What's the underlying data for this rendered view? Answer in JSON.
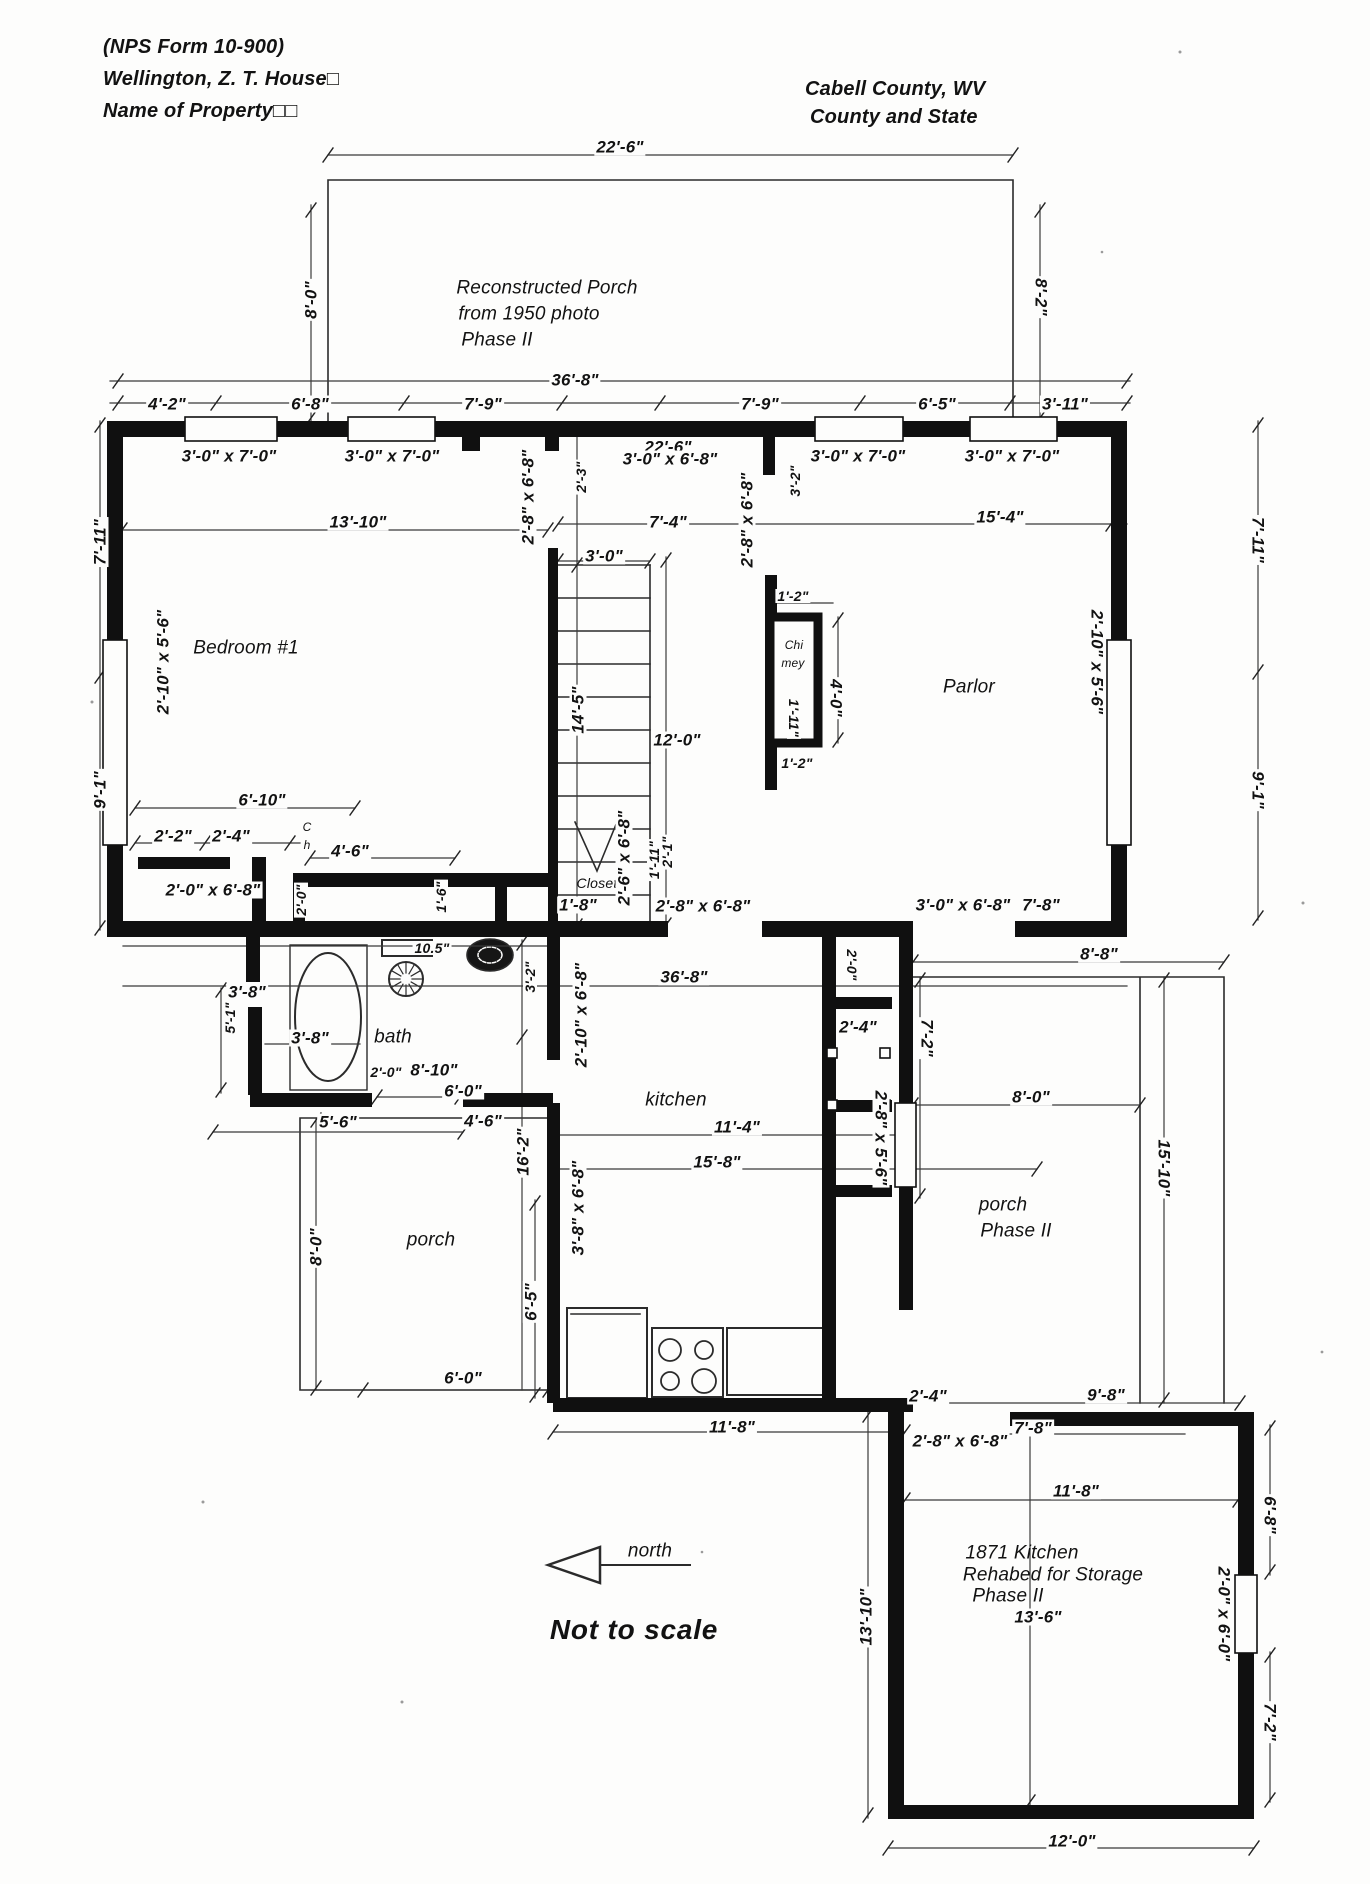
{
  "header": {
    "left": [
      "(NPS Form 10-900)",
      "Wellington, Z. T. House□",
      "Name of Property□□"
    ],
    "right": [
      "Cabell County, WV",
      "County and State"
    ]
  },
  "labels": [
    {
      "t": "22'-6\"",
      "x": 620,
      "y": 147
    },
    {
      "t": "8'-0\"",
      "x": 311,
      "y": 300,
      "c": "rm90"
    },
    {
      "t": "8'-2\"",
      "x": 1041,
      "y": 297,
      "c": "r90"
    },
    {
      "t": "Reconstructed Porch",
      "x": 547,
      "y": 288,
      "c": "room"
    },
    {
      "t": "from 1950 photo",
      "x": 529,
      "y": 314,
      "c": "room"
    },
    {
      "t": "Phase II",
      "x": 497,
      "y": 340,
      "c": "room"
    },
    {
      "t": "36'-8\"",
      "x": 575,
      "y": 380
    },
    {
      "t": "4'-2\"",
      "x": 167,
      "y": 404
    },
    {
      "t": "6'-8\"",
      "x": 310,
      "y": 404
    },
    {
      "t": "7'-9\"",
      "x": 483,
      "y": 404
    },
    {
      "t": "7'-9\"",
      "x": 760,
      "y": 404
    },
    {
      "t": "6'-5\"",
      "x": 937,
      "y": 404
    },
    {
      "t": "3'-11\"",
      "x": 1065,
      "y": 404
    },
    {
      "t": "3'-0\" x 7'-0\"",
      "x": 229,
      "y": 456
    },
    {
      "t": "3'-0\" x 7'-0\"",
      "x": 392,
      "y": 456
    },
    {
      "t": "22'-6\"",
      "x": 668,
      "y": 447
    },
    {
      "t": "3'-0\" x 6'-8\"",
      "x": 670,
      "y": 459
    },
    {
      "t": "3'-0\" x 7'-0\"",
      "x": 858,
      "y": 456
    },
    {
      "t": "3'-0\" x 7'-0\"",
      "x": 1012,
      "y": 456
    },
    {
      "t": "2'-8\" x 6'-8\"",
      "x": 528,
      "y": 497,
      "c": "rm90"
    },
    {
      "t": "2'-3\"",
      "x": 581,
      "y": 477,
      "c": "rm90 small"
    },
    {
      "t": "2'-8\" x 6'-8\"",
      "x": 747,
      "y": 520,
      "c": "rm90"
    },
    {
      "t": "3'-2\"",
      "x": 795,
      "y": 481,
      "c": "rm90 small"
    },
    {
      "t": "13'-10\"",
      "x": 358,
      "y": 522
    },
    {
      "t": "7'-4\"",
      "x": 668,
      "y": 522
    },
    {
      "t": "15'-4\"",
      "x": 1000,
      "y": 517
    },
    {
      "t": "7'-11\"",
      "x": 100,
      "y": 542,
      "c": "rm90"
    },
    {
      "t": "9'-1\"",
      "x": 100,
      "y": 790,
      "c": "rm90"
    },
    {
      "t": "2'-10\" x 5'-6\"",
      "x": 163,
      "y": 662,
      "c": "rm90"
    },
    {
      "t": "Bedroom #1",
      "x": 246,
      "y": 648,
      "c": "room"
    },
    {
      "t": "3'-0\"",
      "x": 604,
      "y": 556
    },
    {
      "t": "14'-5\"",
      "x": 578,
      "y": 710,
      "c": "rm90"
    },
    {
      "t": "12'-0\"",
      "x": 677,
      "y": 740
    },
    {
      "t": "1'-2\"",
      "x": 793,
      "y": 596,
      "c": "small"
    },
    {
      "t": "Chi",
      "x": 794,
      "y": 645,
      "c": "tiny"
    },
    {
      "t": "mey",
      "x": 793,
      "y": 663,
      "c": "tiny"
    },
    {
      "t": "4'-0\"",
      "x": 836,
      "y": 698,
      "c": "r90"
    },
    {
      "t": "1'-11\"",
      "x": 794,
      "y": 718,
      "c": "r90 small"
    },
    {
      "t": "1'-2\"",
      "x": 797,
      "y": 763,
      "c": "small"
    },
    {
      "t": "Parlor",
      "x": 969,
      "y": 687,
      "c": "room"
    },
    {
      "t": "2'-10\" x 5'-6\"",
      "x": 1097,
      "y": 662,
      "c": "r90"
    },
    {
      "t": "7'-11\"",
      "x": 1258,
      "y": 540,
      "c": "r90"
    },
    {
      "t": "9'-1\"",
      "x": 1258,
      "y": 790,
      "c": "r90"
    },
    {
      "t": "6'-10\"",
      "x": 262,
      "y": 800
    },
    {
      "t": "2'-2\"",
      "x": 173,
      "y": 836
    },
    {
      "t": "2'-4\"",
      "x": 231,
      "y": 836
    },
    {
      "t": "C",
      "x": 307,
      "y": 827,
      "c": "tiny"
    },
    {
      "t": "h",
      "x": 307,
      "y": 845,
      "c": "tiny"
    },
    {
      "t": "4'-6\"",
      "x": 350,
      "y": 851
    },
    {
      "t": "2'-0\" x 6'-8\"",
      "x": 213,
      "y": 890
    },
    {
      "t": "2'-0\"",
      "x": 301,
      "y": 900,
      "c": "rm90 small"
    },
    {
      "t": "1'-6\"",
      "x": 441,
      "y": 897,
      "c": "rm90 small"
    },
    {
      "t": "Closet",
      "x": 597,
      "y": 883,
      "c": "room small"
    },
    {
      "t": "1'-8\"",
      "x": 578,
      "y": 905
    },
    {
      "t": "2'-6\" x 6'-8\"",
      "x": 624,
      "y": 858,
      "c": "rm90"
    },
    {
      "t": "1'-11\"",
      "x": 654,
      "y": 860,
      "c": "rm90 small"
    },
    {
      "t": "2'-1\"",
      "x": 667,
      "y": 852,
      "c": "rm90 small"
    },
    {
      "t": "2'-8\" x 6'-8\"",
      "x": 703,
      "y": 906
    },
    {
      "t": "3'-0\" x 6'-8\"",
      "x": 963,
      "y": 905
    },
    {
      "t": "7'-8\"",
      "x": 1041,
      "y": 905
    },
    {
      "t": "8'-8\"",
      "x": 1099,
      "y": 954
    },
    {
      "t": "36'-8\"",
      "x": 684,
      "y": 977
    },
    {
      "t": "3'-8\"",
      "x": 247,
      "y": 992
    },
    {
      "t": "5'-1\"",
      "x": 230,
      "y": 1018,
      "c": "rm90 small"
    },
    {
      "t": "3'-8\"",
      "x": 310,
      "y": 1038
    },
    {
      "t": "bath",
      "x": 393,
      "y": 1037,
      "c": "room"
    },
    {
      "t": "10.5\"",
      "x": 432,
      "y": 948,
      "c": "small"
    },
    {
      "t": "2'-0\"",
      "x": 386,
      "y": 1072,
      "c": "small"
    },
    {
      "t": "8'-10\"",
      "x": 434,
      "y": 1070
    },
    {
      "t": "6'-0\"",
      "x": 463,
      "y": 1091
    },
    {
      "t": "3'-2\"",
      "x": 530,
      "y": 977,
      "c": "rm90 small"
    },
    {
      "t": "2'-10\" x 6'-8\"",
      "x": 581,
      "y": 1015,
      "c": "rm90"
    },
    {
      "t": "2'-0\"",
      "x": 852,
      "y": 965,
      "c": "r90 small"
    },
    {
      "t": "2'-4\"",
      "x": 858,
      "y": 1027
    },
    {
      "t": "7'-2\"",
      "x": 927,
      "y": 1038,
      "c": "r90"
    },
    {
      "t": "2'-8\" x 5'-6\"",
      "x": 881,
      "y": 1138,
      "c": "r90"
    },
    {
      "t": "5'-6\"",
      "x": 338,
      "y": 1122
    },
    {
      "t": "4'-6\"",
      "x": 483,
      "y": 1121
    },
    {
      "t": "16'-2\"",
      "x": 523,
      "y": 1152,
      "c": "rm90"
    },
    {
      "t": "kitchen",
      "x": 676,
      "y": 1100,
      "c": "room"
    },
    {
      "t": "11'-4\"",
      "x": 737,
      "y": 1127
    },
    {
      "t": "15'-8\"",
      "x": 717,
      "y": 1162
    },
    {
      "t": "8'-0\"",
      "x": 1031,
      "y": 1097
    },
    {
      "t": "15'-10\"",
      "x": 1164,
      "y": 1168,
      "c": "r90"
    },
    {
      "t": "porch",
      "x": 1003,
      "y": 1205,
      "c": "room"
    },
    {
      "t": "Phase II",
      "x": 1016,
      "y": 1231,
      "c": "room"
    },
    {
      "t": "porch",
      "x": 431,
      "y": 1240,
      "c": "room"
    },
    {
      "t": "8'-0\"",
      "x": 316,
      "y": 1247,
      "c": "rm90"
    },
    {
      "t": "3'-8\" x 6'-8\"",
      "x": 578,
      "y": 1208,
      "c": "rm90"
    },
    {
      "t": "6'-5\"",
      "x": 531,
      "y": 1302,
      "c": "rm90"
    },
    {
      "t": "6'-0\"",
      "x": 463,
      "y": 1378
    },
    {
      "t": "11'-8\"",
      "x": 732,
      "y": 1427
    },
    {
      "t": "2'-4\"",
      "x": 928,
      "y": 1396
    },
    {
      "t": "9'-8\"",
      "x": 1106,
      "y": 1395
    },
    {
      "t": "7'-8\"",
      "x": 1033,
      "y": 1428
    },
    {
      "t": "2'-8\" x 6'-8\"",
      "x": 960,
      "y": 1441
    },
    {
      "t": "11'-8\"",
      "x": 1076,
      "y": 1491
    },
    {
      "t": "1871 Kitchen",
      "x": 1022,
      "y": 1553,
      "c": "room"
    },
    {
      "t": "Rehabed for Storage",
      "x": 1053,
      "y": 1575,
      "c": "room"
    },
    {
      "t": "Phase II",
      "x": 1008,
      "y": 1596,
      "c": "room"
    },
    {
      "t": "13'-6\"",
      "x": 1038,
      "y": 1617
    },
    {
      "t": "13'-10\"",
      "x": 866,
      "y": 1617,
      "c": "rm90"
    },
    {
      "t": "6'-8\"",
      "x": 1270,
      "y": 1515,
      "c": "r90"
    },
    {
      "t": "2'-0\" x 6'-0\"",
      "x": 1224,
      "y": 1614,
      "c": "r90"
    },
    {
      "t": "7'-2\"",
      "x": 1270,
      "y": 1722,
      "c": "r90"
    },
    {
      "t": "12'-0\"",
      "x": 1072,
      "y": 1841
    },
    {
      "t": "north",
      "x": 650,
      "y": 1551,
      "c": "room"
    },
    {
      "t": "Not to scale",
      "x": 634,
      "y": 1630,
      "c": "big"
    }
  ]
}
